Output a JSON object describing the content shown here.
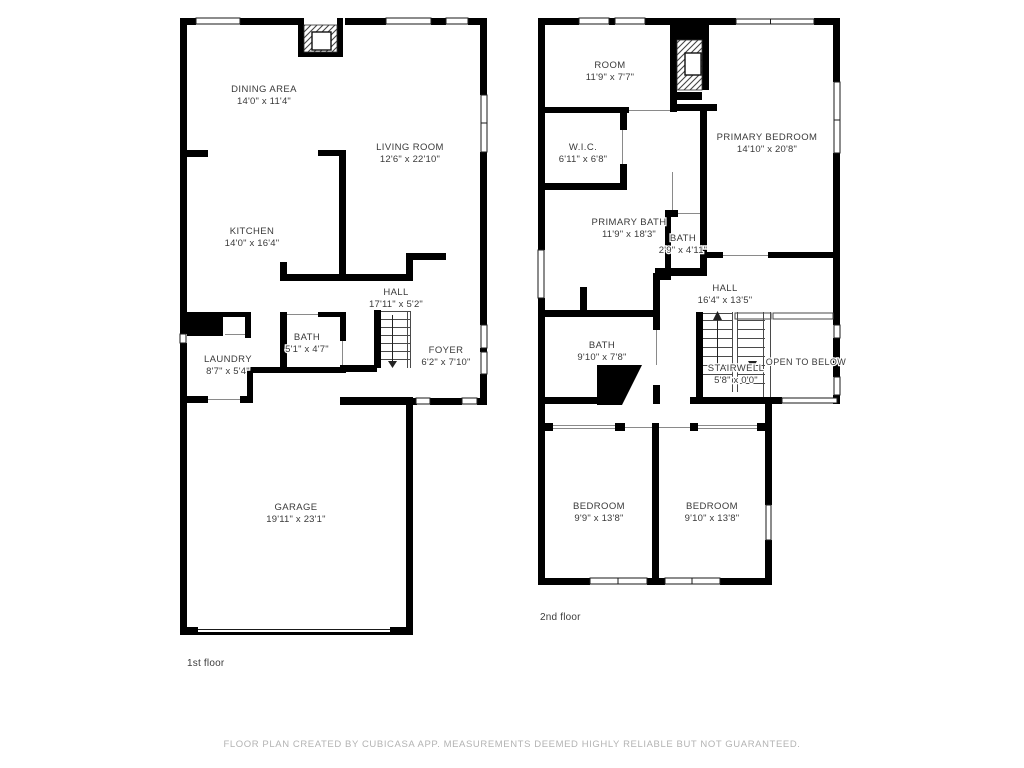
{
  "colors": {
    "wall": "#000000",
    "label_text": "#3a3a3a",
    "caption_text": "#3c3c3c",
    "footer_text": "#b3b3b3",
    "background": "#ffffff"
  },
  "floors": [
    {
      "caption": "1st floor",
      "rooms": [
        {
          "name": "DINING AREA",
          "dims": "14'0\" x 11'4\""
        },
        {
          "name": "LIVING ROOM",
          "dims": "12'6\" x 22'10\""
        },
        {
          "name": "KITCHEN",
          "dims": "14'0\" x 16'4\""
        },
        {
          "name": "HALL",
          "dims": "17'11\" x 5'2\""
        },
        {
          "name": "BATH",
          "dims": "5'1\" x 4'7\""
        },
        {
          "name": "LAUNDRY",
          "dims": "8'7\" x 5'4\""
        },
        {
          "name": "FOYER",
          "dims": "6'2\" x 7'10\""
        },
        {
          "name": "GARAGE",
          "dims": "19'11\" x 23'1\""
        }
      ]
    },
    {
      "caption": "2nd floor",
      "rooms": [
        {
          "name": "ROOM",
          "dims": "11'9\" x 7'7\""
        },
        {
          "name": "W.I.C.",
          "dims": "6'11\" x 6'8\""
        },
        {
          "name": "PRIMARY BEDROOM",
          "dims": "14'10\" x 20'8\""
        },
        {
          "name": "PRIMARY BATH",
          "dims": "11'9\" x 18'3\""
        },
        {
          "name": "BATH",
          "dims": "2'9\" x 4'11\""
        },
        {
          "name": "HALL",
          "dims": "16'4\" x 13'5\""
        },
        {
          "name": "BATH",
          "dims": "9'10\" x 7'8\""
        },
        {
          "name": "STAIRWELL",
          "dims": "5'8\" x 0'0\""
        },
        {
          "name": "OPEN TO BELOW",
          "dims": ""
        },
        {
          "name": "BEDROOM",
          "dims": "9'9\" x 13'8\""
        },
        {
          "name": "BEDROOM",
          "dims": "9'10\" x 13'8\""
        }
      ]
    }
  ],
  "footer": "FLOOR PLAN CREATED BY CUBICASA APP. MEASUREMENTS DEEMED HIGHLY RELIABLE BUT NOT GUARANTEED."
}
